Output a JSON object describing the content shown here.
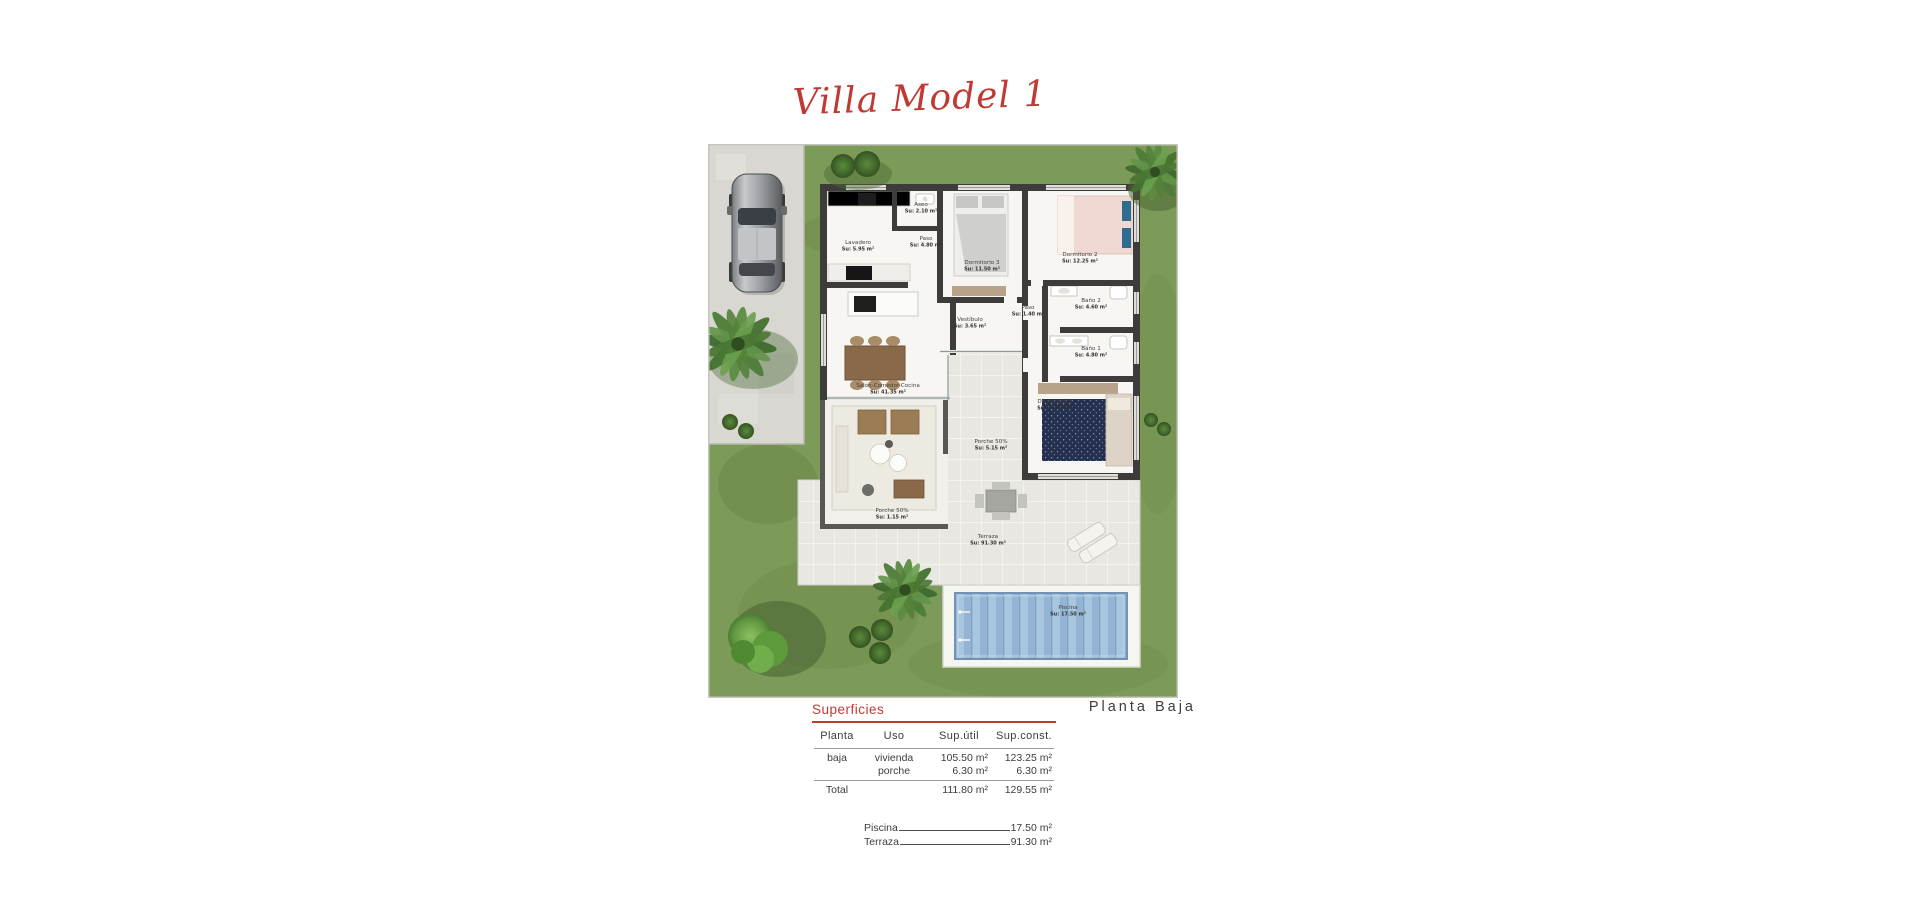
{
  "title": "Villa Model 1",
  "floor_label": "Planta Baja",
  "surfaces": {
    "heading": "Superficies",
    "columns": [
      "Planta",
      "Uso",
      "Sup.útil",
      "Sup.const."
    ],
    "rows": [
      {
        "planta": "baja",
        "uso": "vivienda",
        "util": "105.50 m²",
        "construida": "123.25 m²"
      },
      {
        "planta": "",
        "uso": "porche",
        "util": "6.30 m²",
        "construida": "6.30 m²"
      }
    ],
    "total": {
      "label": "Total",
      "util": "111.80 m²",
      "construida": "129.55 m²"
    },
    "extras": [
      {
        "label": "Piscina",
        "value": "17.50 m²"
      },
      {
        "label": "Terraza",
        "value": "91.30 m²"
      }
    ]
  },
  "plan": {
    "rooms": [
      {
        "name": "Lavadero",
        "area": "Su: 5.95 m²",
        "x": 150,
        "y": 100
      },
      {
        "name": "Aseo",
        "area": "Su: 2.10 m²",
        "x": 213,
        "y": 62
      },
      {
        "name": "Paso",
        "area": "Su: 4.80 m²",
        "x": 218,
        "y": 96
      },
      {
        "name": "Dormitorio 3",
        "area": "Su: 11.50 m²",
        "x": 274,
        "y": 120
      },
      {
        "name": "Dormitorio 2",
        "area": "Su: 12.25 m²",
        "x": 372,
        "y": 112
      },
      {
        "name": "Baño 2",
        "area": "Su: 4.60 m²",
        "x": 383,
        "y": 158
      },
      {
        "name": "Paso",
        "area": "Su: 1.40 m²",
        "x": 320,
        "y": 165
      },
      {
        "name": "Baño 1",
        "area": "Su: 4.80 m²",
        "x": 383,
        "y": 206
      },
      {
        "name": "Vestíbulo",
        "area": "Su: 3.65 m²",
        "x": 262,
        "y": 177
      },
      {
        "name": "Dormitorio 1",
        "area": "Su: 16.95 m²",
        "x": 347,
        "y": 259
      },
      {
        "name": "Salón-Comedor-Cocina",
        "area": "Su: 41.35 m²",
        "x": 180,
        "y": 243
      },
      {
        "name": "Porche 50%",
        "area": "Su: 5.15 m²",
        "x": 283,
        "y": 299
      },
      {
        "name": "Porche 50%",
        "area": "Su: 1.15 m²",
        "x": 184,
        "y": 368
      },
      {
        "name": "Terraza",
        "area": "Su: 91.30 m²",
        "x": 280,
        "y": 394
      },
      {
        "name": "Piscina",
        "area": "Su: 17.50 m²",
        "x": 360,
        "y": 465
      }
    ]
  }
}
